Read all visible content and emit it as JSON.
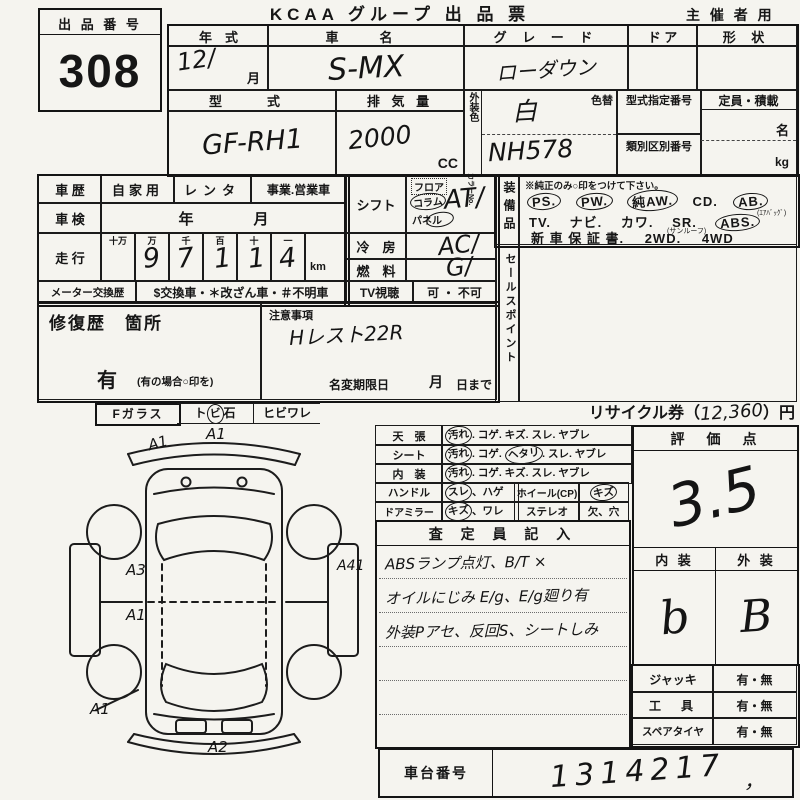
{
  "header": {
    "title": "KCAA グループ 出 品 票",
    "audience": "主 催 者 用"
  },
  "lot": {
    "label": "出 品 番 号",
    "number": "308"
  },
  "vehicle": {
    "year_label": "年　式",
    "year_value": "12∕",
    "month": "月",
    "name_label": "車　名",
    "name_value": "S-MX",
    "grade_label": "グ レ ー ド",
    "grade_value": "ローダウン",
    "door_label": "ド ア",
    "shape_label": "形 状",
    "model_label": "型　式",
    "model_value": "GF-RH1",
    "disp_label": "排 気 量",
    "disp_value": "2000",
    "disp_unit": "CC",
    "color_label": "外装色",
    "color_no_label": "カラーNo.",
    "color_change": "色替",
    "color_value": "白",
    "color_no_value": "NH578",
    "type_no_label": "型式指定番号",
    "class_no_label": "類別区別番号",
    "capacity_label": "定員・積載",
    "capacity_person": "名",
    "capacity_kg": "kg"
  },
  "history": {
    "label": "車 歴",
    "opt_private": "自家用",
    "opt_rental": "レンタ",
    "opt_business": "事業.営業車"
  },
  "shaken": {
    "label": "車 検",
    "value": "年　　　　月"
  },
  "odometer": {
    "label": "走 行",
    "cols": [
      "十万",
      "万",
      "千",
      "百",
      "十",
      "一"
    ],
    "digits": [
      "",
      "9",
      "7",
      "1",
      "1",
      "4"
    ],
    "unit": "km"
  },
  "meter": {
    "label": "メーター交換歴",
    "value": "$交換車・＊改ざん車・＃不明車"
  },
  "shift": {
    "label": "シフト",
    "opt_floor": "フロア",
    "opt_column": "コラム",
    "opt_panel": "パネル",
    "value": "AT∕"
  },
  "cooling": {
    "label": "冷　房",
    "value": "AC∕"
  },
  "fuel": {
    "label": "燃　料",
    "value": "G∕"
  },
  "tv": {
    "label": "TV視聴",
    "value": "可 ・ 不可"
  },
  "equipment": {
    "side_label": "装備品",
    "note": "※純正のみ○印をつけて下さい。",
    "row1": [
      "PS.",
      "PW.",
      "純AW.",
      "CD.",
      "AB."
    ],
    "ab_note": "(ｴｱﾊﾞｯｸﾞ)",
    "row2": [
      "TV.",
      "ナビ.",
      "カワ.",
      "SR.",
      "ABS."
    ],
    "sr_note": "(サンルーフ)",
    "row3": [
      "新 車 保 証 書.",
      "2WD.",
      "4WD"
    ]
  },
  "sales_point": {
    "label": "セールスポイント"
  },
  "repair": {
    "label": "修復歴　箇所",
    "has": "有",
    "has_note": "(有の場合○印を)",
    "caution_label": "注意事項",
    "caution_value": "Hレスト22R",
    "rename_label": "名変期限日",
    "rename_month": "月",
    "rename_day": "日まで"
  },
  "recycle": {
    "prefix": "リサイクル券（",
    "amount": "12,360",
    "suffix": "）円"
  },
  "fglass": {
    "label": "Fガラス",
    "opt1a": "ト",
    "opt1b": "ビ",
    "opt1c": "石",
    "opt2": "ヒビワレ"
  },
  "diagram": {
    "labels": [
      "A1",
      "A1",
      "A3",
      "A1",
      "A1",
      "A2",
      "A41"
    ]
  },
  "condition": {
    "r0l": "天　張",
    "r0a": "汚れ",
    "r0b": ". コゲ. キズ. スレ. ヤブレ",
    "r1l": "シート",
    "r1a": "汚れ",
    "r1b": ". コゲ. ",
    "r1c": "ヘタリ",
    "r1d": ". スレ. ヤブレ",
    "r2l": "内　装",
    "r2a": "汚れ",
    "r2b": ". コゲ. キズ. スレ. ヤブレ",
    "r3l": "ハンドル",
    "r3a": "スレ",
    "r3b": "、ハゲ",
    "r3c": "ホイール(CP)",
    "r3d": "キズ",
    "r4l": "ドアミラー",
    "r4a": "キズ",
    "r4b": "、ワレ",
    "r4c": "ステレオ",
    "r4d": "欠、穴"
  },
  "inspector": {
    "header": "査 定 員 記 入",
    "notes": [
      "ABSランプ点灯、B/T ×",
      "オイルにじみ E/g、E/g廻り有",
      "外装Pアセ、反回S、シートしみ"
    ]
  },
  "evaluation": {
    "header": "評　価　点",
    "score": "3.5",
    "interior_label": "内 装",
    "exterior_label": "外 装",
    "interior_grade": "b",
    "exterior_grade": "B"
  },
  "accessories": {
    "rows": [
      {
        "label": "ジャッキ",
        "value": "有・無"
      },
      {
        "label": "工　具",
        "value": "有・無"
      },
      {
        "label": "スペアタイヤ",
        "value": "有・無"
      }
    ]
  },
  "chassis": {
    "label": "車台番号",
    "value": "1314217",
    "tick": "，"
  }
}
